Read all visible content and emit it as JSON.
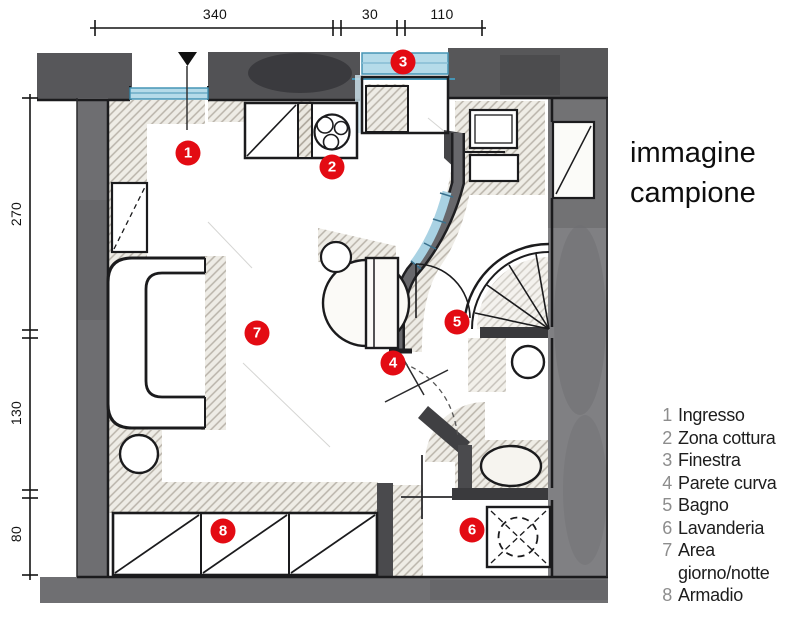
{
  "watermark": {
    "line1": "immagine",
    "line2": "campione"
  },
  "dimensions": {
    "top_labels": [
      "340",
      "30",
      "110"
    ],
    "left_labels": [
      "270",
      "130",
      "80"
    ]
  },
  "markers": [
    "1",
    "2",
    "3",
    "4",
    "5",
    "6",
    "7",
    "8"
  ],
  "legend": {
    "items": [
      {
        "num": "1",
        "label": "Ingresso"
      },
      {
        "num": "2",
        "label": "Zona cottura"
      },
      {
        "num": "3",
        "label": "Finestra"
      },
      {
        "num": "4",
        "label": "Parete curva"
      },
      {
        "num": "5",
        "label": "Bagno"
      },
      {
        "num": "6",
        "label": "Lavanderia"
      },
      {
        "num": "7",
        "label": "Area\ngiorno/notte"
      },
      {
        "num": "8",
        "label": "Armadio"
      }
    ]
  },
  "colors": {
    "marker_red": "#e30b13",
    "glass_blue": "#b5dbe9",
    "glass_blue_line": "#4695b5",
    "wall_gray": "#6b6b6e",
    "hatch_line": "#a8a195",
    "ink_black": "#1b1b1d"
  }
}
